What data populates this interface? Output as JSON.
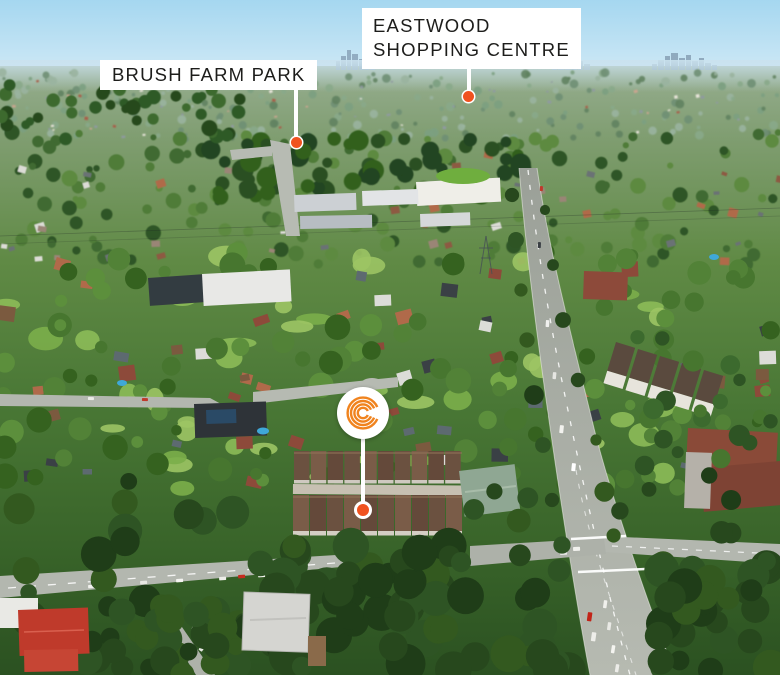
{
  "scene": {
    "type": "aerial-property-photograph",
    "callouts": [
      {
        "id": "eastwood-shopping-centre",
        "lines": [
          "EASTWOOD",
          "SHOPPING CENTRE"
        ]
      },
      {
        "id": "brush-farm-park",
        "lines": [
          "BRUSH FARM PARK"
        ]
      }
    ],
    "property_marker": {
      "logo_letter": "C"
    },
    "colors": {
      "brand_orange": "#F0831E",
      "pin_orange": "#F0521F",
      "callout_bg": "#FFFFFF",
      "callout_text": "#1D1D1B"
    }
  }
}
